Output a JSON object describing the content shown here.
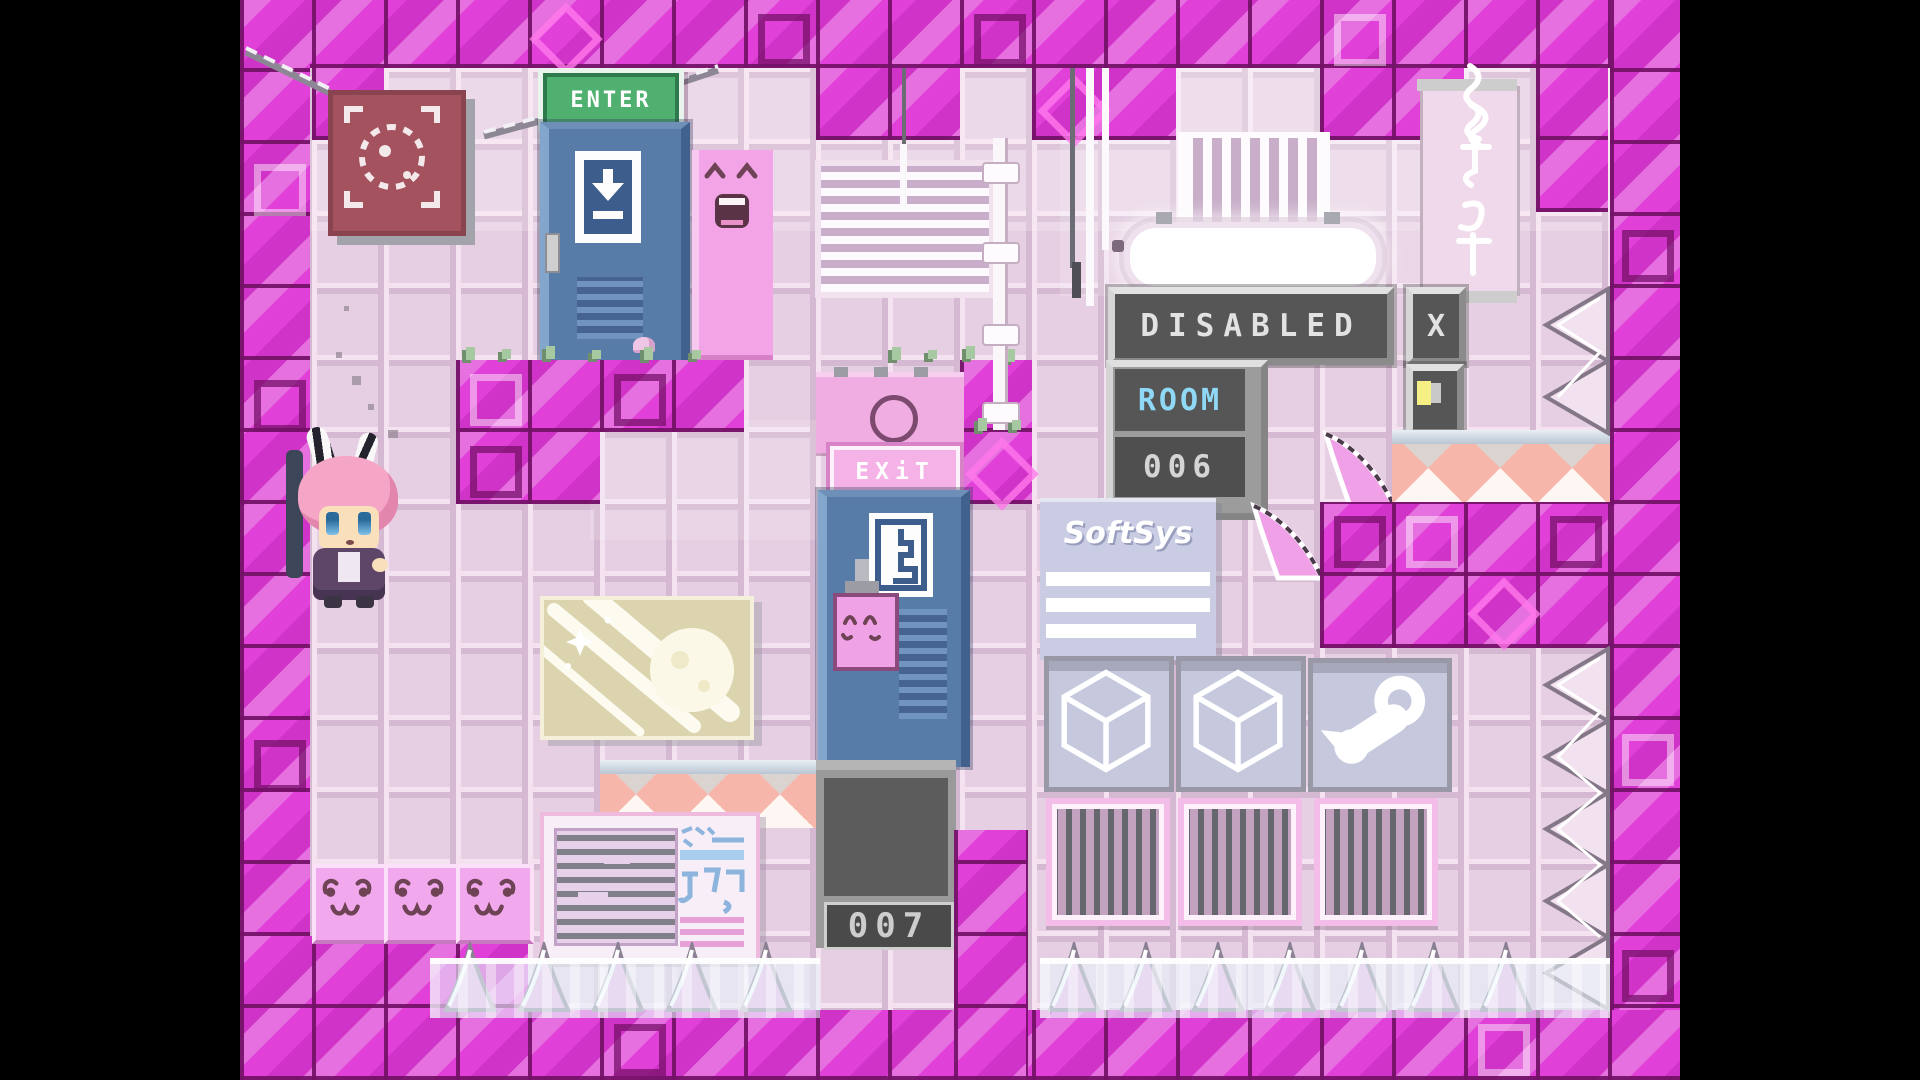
{
  "scene": {
    "type": "pixel-art platformer room",
    "letterbox": "black side bars"
  },
  "doors": {
    "enter": {
      "sign": "ENTER",
      "icon": "down-arrow-door-icon"
    },
    "exit": {
      "sign": "EXiT",
      "icon": "exit-door-icon"
    }
  },
  "panels": {
    "disabled": {
      "label": "DISABLED"
    },
    "close": {
      "label": "X"
    },
    "room": {
      "label": "ROOM",
      "number": "006"
    },
    "pit": {
      "number": "007"
    },
    "toggle": {
      "icon": "lamp-toggle-icon"
    }
  },
  "posters": {
    "softsys": {
      "brand": "SoftSys"
    },
    "aircon": {
      "text": "エアコン"
    },
    "target": {
      "icon": "focus-target-icon"
    },
    "moon": {
      "icon": "shooting-moon-art"
    },
    "scroll": {
      "icon": "calligraphy-scroll"
    }
  },
  "decor": {
    "steam": "steam-logo",
    "cubes": "wireframe-cube",
    "smiley_blocks": 3,
    "happy_slab_face": "laughing",
    "player": "pink-bunny-girl"
  },
  "colors": {
    "letterbox": "#000000",
    "wall_pink": "#e7cfe3",
    "block_magenta": "#de39d6",
    "seam_purple": "#741268",
    "panel_dark": "#565656",
    "room_text_cyan": "#8fd9f6",
    "digit_gray": "#d4d4d4",
    "sign_green": "#4fb070",
    "exit_pink": "#f4b2e6",
    "door_blue": "#577ca8",
    "poster_maroon": "#a5525f",
    "softsys_lavender": "#c9cce2",
    "water_ice": "#e8f4fa",
    "cone_pink": "#e9b4e4"
  }
}
